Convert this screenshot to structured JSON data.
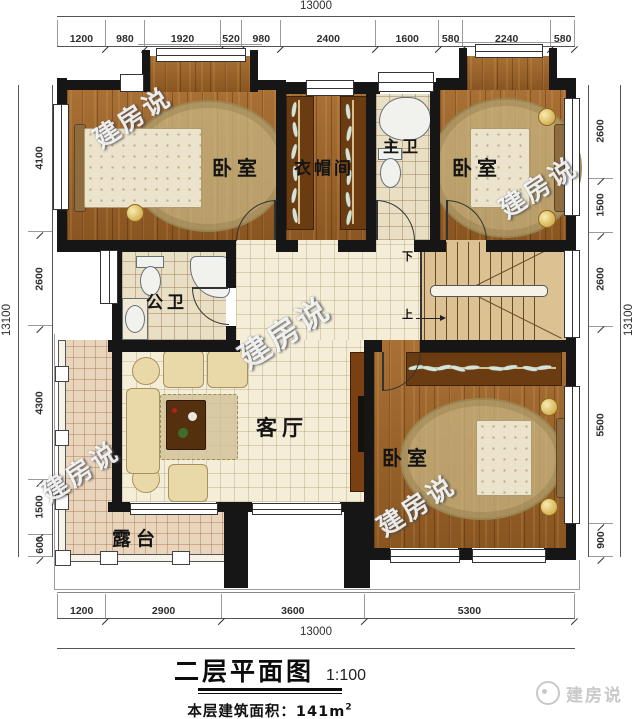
{
  "colors": {
    "wall": "#161616",
    "wood_floor": "#9a6126",
    "tile_floor": "#e9dfc4",
    "hall_floor": "#f4edd8",
    "terrace_floor": "#e9d4bc",
    "stair_floor": "#dcc193",
    "watermark_white": "#f8f8f8",
    "dim_text": "#2e2e2e",
    "logo_gray": "#c9c9c9"
  },
  "watermark": {
    "text": "建房说"
  },
  "dims": {
    "top": {
      "total": "13000",
      "segments": [
        "1200",
        "980",
        "1920",
        "520",
        "980",
        "2400",
        "1600",
        "580",
        "2240",
        "580"
      ]
    },
    "bottom": {
      "total": "13000",
      "segments": [
        "1200",
        "2900",
        "3600",
        "5300"
      ]
    },
    "left": {
      "total": "13100",
      "segments": [
        "4100",
        "2600",
        "4300",
        "1500",
        "600"
      ]
    },
    "right": {
      "total": "13100",
      "segments": [
        "2600",
        "1500",
        "2600",
        "5500",
        "900"
      ]
    }
  },
  "rooms": {
    "bedroom_top_left": "卧室",
    "cloakroom": "衣帽间",
    "master_bath": "主卫",
    "bedroom_top_right": "卧室",
    "public_bath": "公卫",
    "living_room": "客厅",
    "bedroom_bottom_right": "卧室",
    "terrace": "露台"
  },
  "stairs": {
    "down": "下",
    "up": "上"
  },
  "titleblock": {
    "title": "二层平面图",
    "scale": "1:100",
    "area_label": "本层建筑面积：141m",
    "area_sup": "2"
  },
  "logo": {
    "text": "建房说"
  }
}
